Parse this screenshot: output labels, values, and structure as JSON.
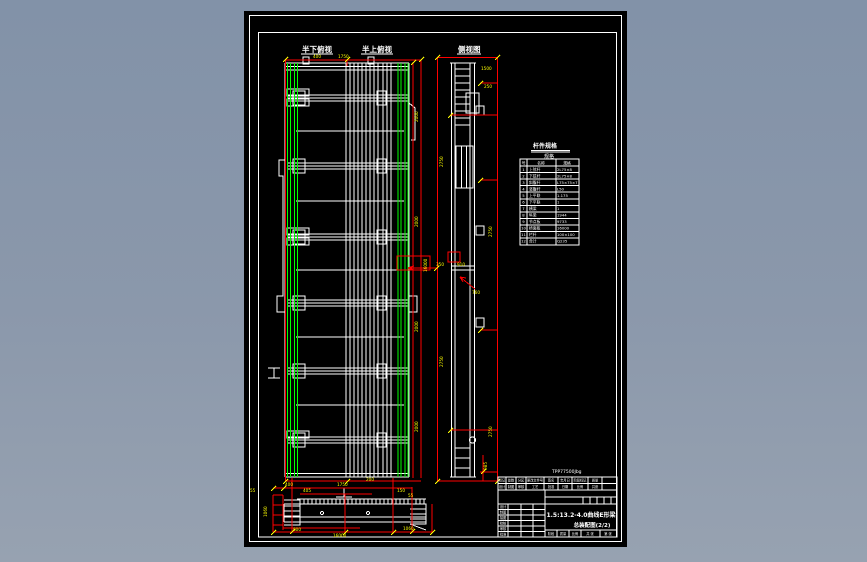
{
  "app": {
    "type": "cad-drawing-view",
    "canvas_bg": "#000000",
    "surround_bg": "#8b98ab"
  },
  "colors": {
    "line_white": "#ffffff",
    "chord_green": "#00ff00",
    "dimension_red": "#ff0000",
    "dim_text_yellow": "#ffff00"
  },
  "labels": {
    "plan_bottom": "半下俯视",
    "plan_top": "半上俯视",
    "side": "侧视图",
    "section_mark": "工"
  },
  "spec_table": {
    "title": "杆件规格",
    "subtitle": "规格",
    "headers": [
      "号",
      "名称",
      "规格"
    ],
    "rows": [
      [
        "1",
        "上弦杆",
        "2L75×8"
      ],
      [
        "2",
        "下弦杆",
        "2L75×8"
      ],
      [
        "3",
        "斜腹杆",
        "L75×75×7"
      ],
      [
        "4",
        "竖腹杆",
        "L50"
      ],
      [
        "5",
        "上平联",
        "1.175"
      ],
      [
        "6",
        "下平联",
        "1"
      ],
      [
        "7",
        "横梁",
        "1"
      ],
      [
        "8",
        "纵梁",
        "1944"
      ],
      [
        "9",
        "节点板",
        "9733"
      ],
      [
        "10",
        "桥面板",
        "16000"
      ],
      [
        "11",
        "栏杆",
        "100×100"
      ],
      [
        "12",
        "合计",
        "Q235"
      ]
    ]
  },
  "title_block": {
    "doc_number": "TPP77500Jbg",
    "rev_row1": [
      "标记",
      "处数",
      "分区",
      "更改文件号",
      "签名",
      "年月日",
      "阶段标记",
      "质量"
    ],
    "rev_row2": [
      "设计",
      "制图",
      "审核",
      "工艺",
      "批准",
      "日期",
      "比例",
      "共张"
    ],
    "left_col": [
      "设计",
      "制图",
      "描图",
      "校核",
      "审核",
      "批准"
    ],
    "title_line1": "1.5:13.2-4.0曲线E形梁",
    "title_line2": "总装配图(2/2)",
    "bottom_row": [
      "阶段",
      "质量",
      "比例",
      "共 张",
      "第 张"
    ]
  },
  "dims": [
    "400",
    "1750",
    "2000",
    "2000",
    "2000",
    "2000",
    "16000",
    "1500",
    "250",
    "2750",
    "2750",
    "2750",
    "2750",
    "350",
    "910",
    "760",
    "985",
    "400",
    "1750",
    "405",
    "200",
    "150",
    "55",
    "1060",
    "800",
    "16000",
    "1060",
    "55"
  ]
}
